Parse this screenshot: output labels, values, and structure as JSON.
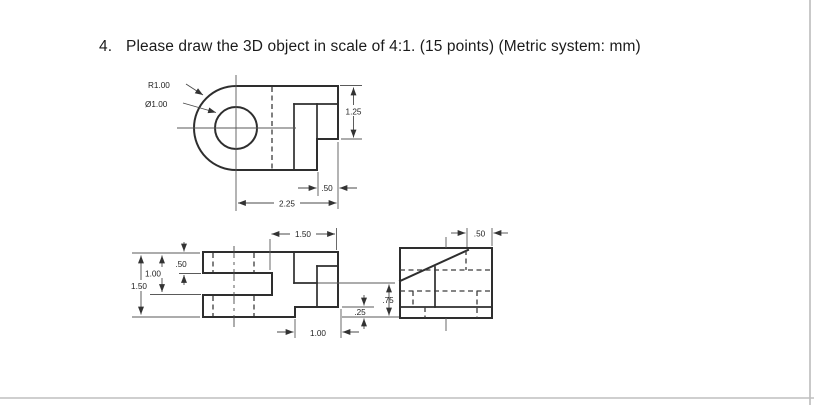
{
  "title": {
    "number": "4.",
    "text": "Please draw the 3D object in scale of 4:1. (15 points) (Metric system: mm)"
  },
  "top_view": {
    "radius": "R1.00",
    "diameter": "Ø1.00",
    "height_right": "1.25",
    "notch_width": ".50",
    "length": "2.25"
  },
  "front_view": {
    "width_right": "1.50",
    "height_overall": "1.50",
    "height_to_slot_bottom": "1.00",
    "tab_height": ".50",
    "step_width": "1.00",
    "step_height": ".25",
    "right_drop": ".75"
  },
  "side_view": {
    "tab_depth": ".50"
  }
}
